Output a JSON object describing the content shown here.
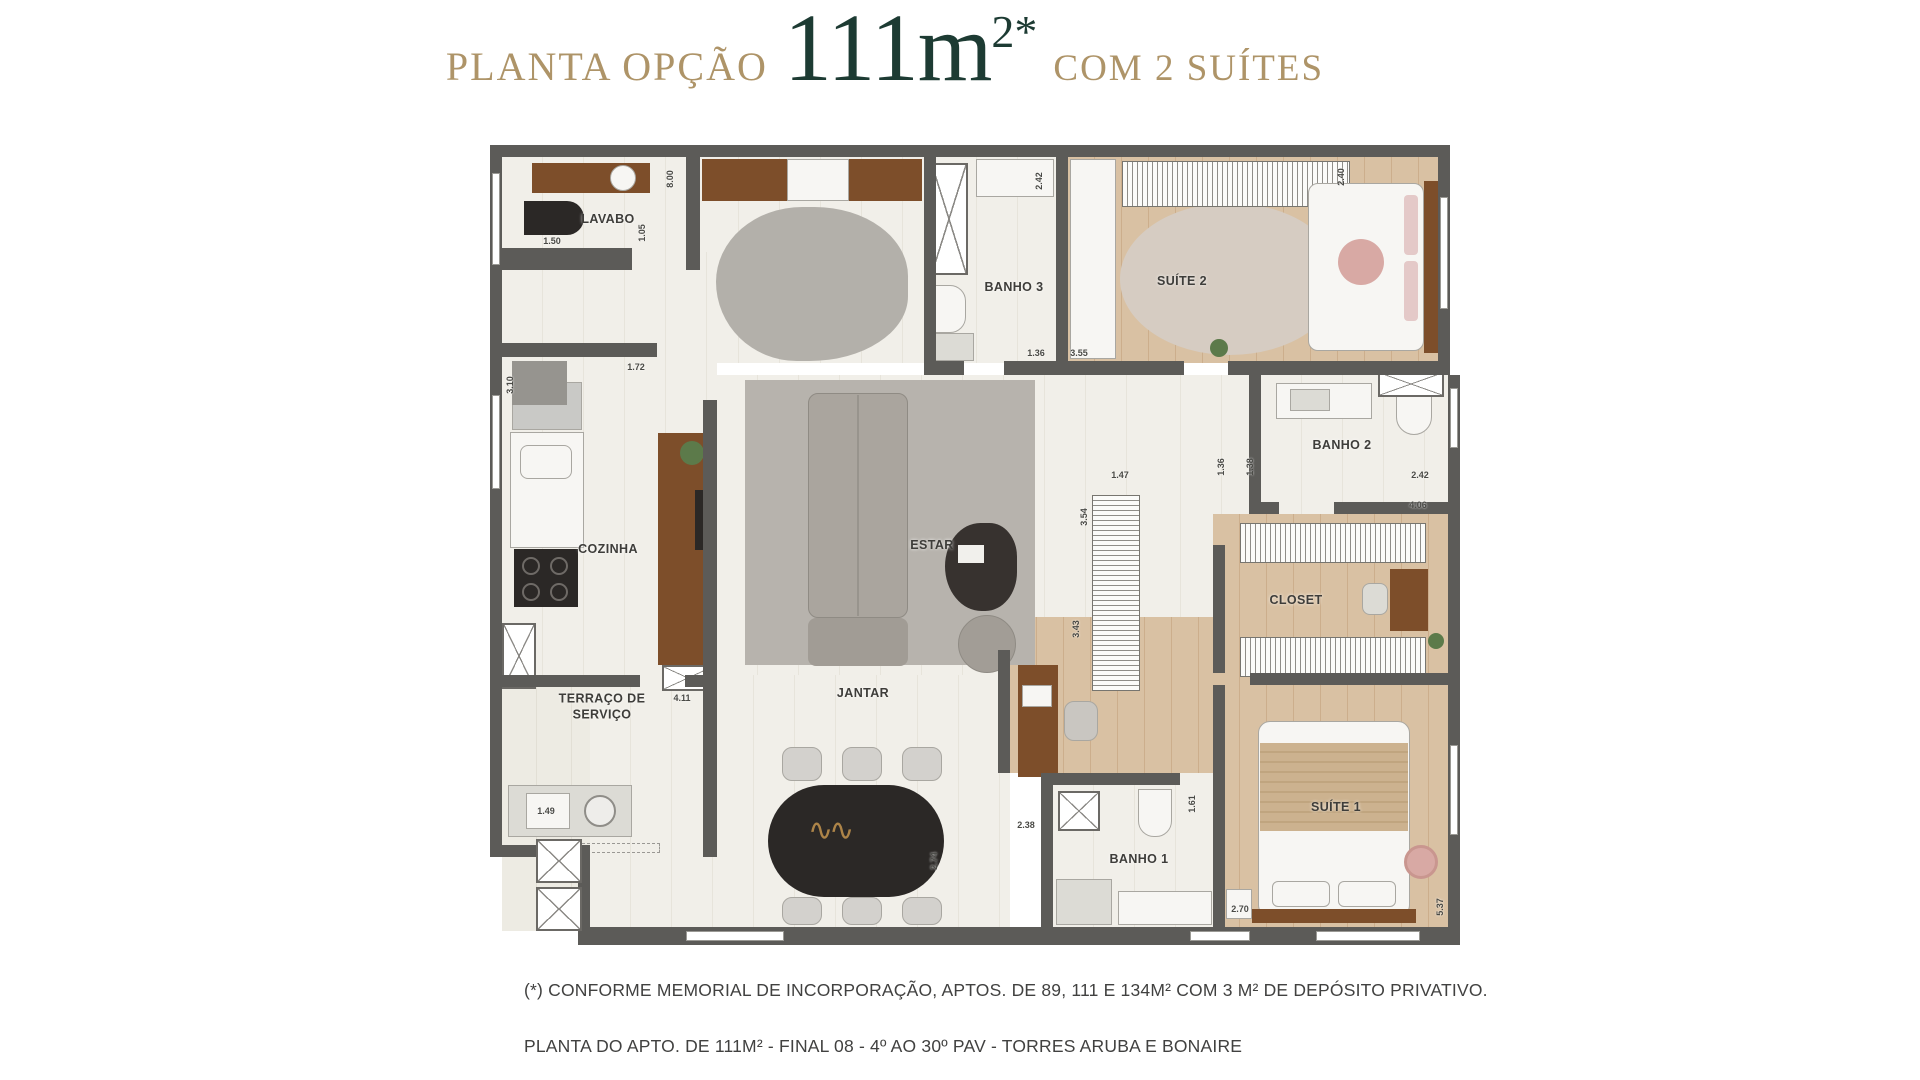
{
  "title": {
    "prefix": "PLANTA OPÇÃO",
    "area": "111m",
    "area_sup": "2*",
    "suffix": "COM 2 SUÍTES"
  },
  "colors": {
    "gold": "#ae9468",
    "green": "#1d3b33",
    "wall": "#5c5b58"
  },
  "rooms": [
    {
      "label": "LAVABO"
    },
    {
      "label": "BANHO 3"
    },
    {
      "label": "SUÍTE 2"
    },
    {
      "label": "COZINHA"
    },
    {
      "label": "ESTAR"
    },
    {
      "label": "BANHO 2"
    },
    {
      "label": "CLOSET"
    },
    {
      "label": "TERRAÇO DE SERVIÇO"
    },
    {
      "label": "JANTAR"
    },
    {
      "label": "BANHO 1"
    },
    {
      "label": "SUÍTE 1"
    }
  ],
  "dims": [
    {
      "v": "1.50"
    },
    {
      "v": "1.05"
    },
    {
      "v": "8.00"
    },
    {
      "v": "2.42"
    },
    {
      "v": "2.40"
    },
    {
      "v": "1.36"
    },
    {
      "v": "3.55"
    },
    {
      "v": "1.72"
    },
    {
      "v": "3.10"
    },
    {
      "v": "1.47"
    },
    {
      "v": "1.36"
    },
    {
      "v": "1.38"
    },
    {
      "v": "2.42"
    },
    {
      "v": "4.06"
    },
    {
      "v": "3.54"
    },
    {
      "v": "3.43"
    },
    {
      "v": "4.11"
    },
    {
      "v": "1.49"
    },
    {
      "v": "2.74"
    },
    {
      "v": "2.38"
    },
    {
      "v": "1.61"
    },
    {
      "v": "2.70"
    },
    {
      "v": "5.37"
    }
  ],
  "footer": {
    "line1": "(*) CONFORME MEMORIAL DE INCORPORAÇÃO, APTOS. DE 89, 111 E 134M² COM 3 M² DE DEPÓSITO PRIVATIVO.",
    "line2": "PLANTA DO APTO. DE 111M² - FINAL 08 - 4º AO 30º PAV - TORRES ARUBA E BONAIRE"
  }
}
